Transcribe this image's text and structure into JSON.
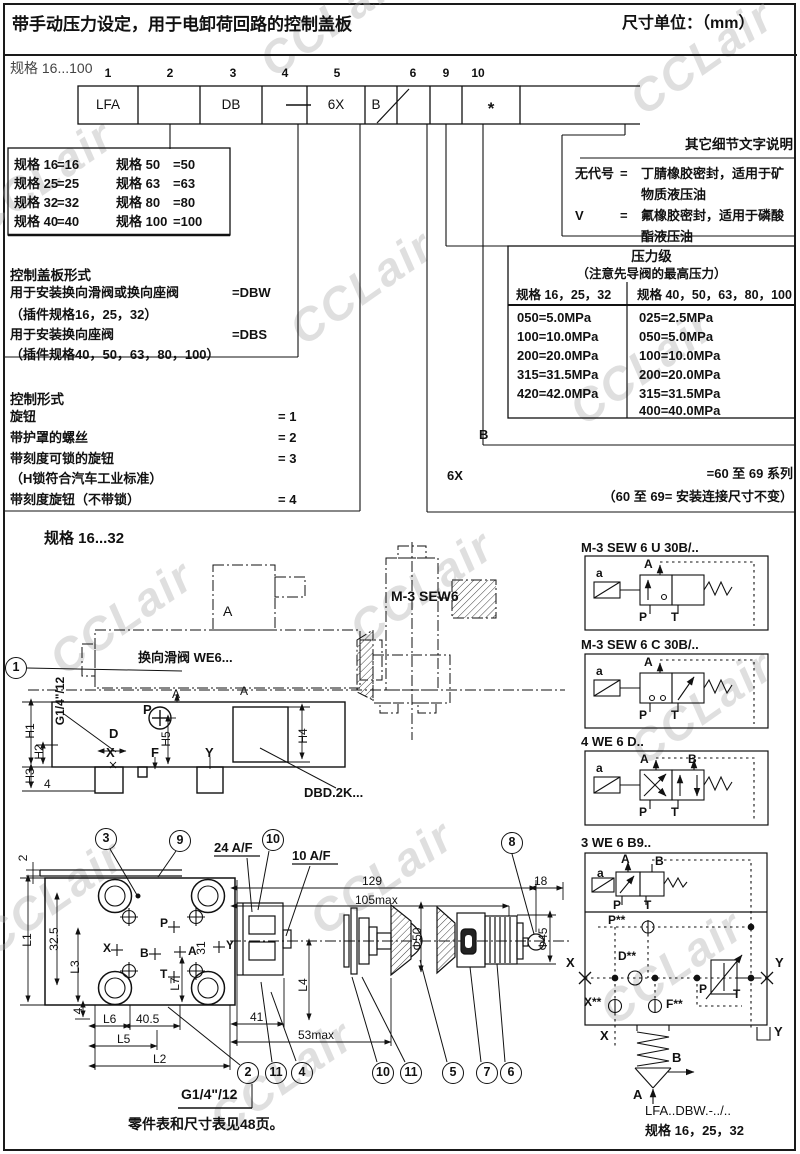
{
  "watermark": "CCLair",
  "header": {
    "title": "带手动压力设定，用于电卸荷回路的控制盖板",
    "units": "尺寸单位：（mm）"
  },
  "ordering": {
    "range": "规格 16...100",
    "positions": [
      "1",
      "2",
      "3",
      "4",
      "5",
      "6",
      "9",
      "10"
    ],
    "cells": {
      "p1": "LFA",
      "p3": "DB",
      "p5": "6X",
      "p6": "B",
      "p10": "*"
    }
  },
  "sizes": {
    "left": [
      {
        "l": "规格 16",
        "v": "=16"
      },
      {
        "l": "规格 25",
        "v": "=25"
      },
      {
        "l": "规格 32",
        "v": "=32"
      },
      {
        "l": "规格 40",
        "v": "=40"
      }
    ],
    "right": [
      {
        "l": "规格 50",
        "v": "=50"
      },
      {
        "l": "规格 63",
        "v": "=63"
      },
      {
        "l": "规格 80",
        "v": "=80"
      },
      {
        "l": "规格 100",
        "v": "=100"
      }
    ]
  },
  "seals": {
    "title": "其它细节文字说明",
    "rows": [
      {
        "code": "无代号",
        "eq": "=",
        "d1": "丁腈橡胶密封，适用于矿",
        "d2": "物质液压油"
      },
      {
        "code": "V",
        "eq": "=",
        "d1": "氟橡胶密封，适用于磷酸",
        "d2": "酯液压油"
      }
    ]
  },
  "cover": {
    "title": "控制盖板形式",
    "rows": [
      {
        "t": "用于安装换向滑阀或换向座阀",
        "v": "=DBW"
      },
      {
        "t": "（插件规格16，25，32）",
        "v": ""
      },
      {
        "t": "用于安装换向座阀",
        "v": "=DBS"
      },
      {
        "t": "（插件规格40，50，63，80，100）",
        "v": ""
      }
    ]
  },
  "pressure": {
    "title": "压力级",
    "subtitle": "（注意先导阀的最高压力）",
    "h1": "规格 16，25，32",
    "h2": "规格 40，50，63，80，100",
    "c1": [
      "050=5.0MPa",
      "100=10.0MPa",
      "200=20.0MPa",
      "315=31.5MPa",
      "420=42.0MPa"
    ],
    "c2": [
      "025=2.5MPa",
      "050=5.0MPa",
      "100=10.0MPa",
      "200=20.0MPa",
      "315=31.5MPa",
      "400=40.0MPa"
    ]
  },
  "control": {
    "title": "控制形式",
    "rows": [
      {
        "t": "旋钮",
        "v": "= 1"
      },
      {
        "t": "带护罩的螺丝",
        "v": "= 2"
      },
      {
        "t": "带刻度可锁的旋钮",
        "v": "= 3"
      },
      {
        "t": "（H锁符合汽车工业标准）",
        "v": ""
      },
      {
        "t": "带刻度旋钮（不带锁）",
        "v": "= 4"
      }
    ]
  },
  "series": {
    "b": "B",
    "code": "6X",
    "l1": "=60 至 69 系列",
    "l2": "（60 至 69= 安装连接尺寸不变）"
  },
  "dwg": {
    "heading": "规格 16...32",
    "c1": "1",
    "valve_ref": "换向滑阀 WE6...",
    "a_top": "A",
    "a_mid": "A",
    "a_mid2": "A",
    "sew": "M-3 SEW6",
    "dbd": "DBD.2K...",
    "g14": "G1/4\"/12",
    "p": "P",
    "d": "D",
    "x": "X",
    "f": "F",
    "y": "Y",
    "n4": "4",
    "h1": "H1",
    "h2": "H2",
    "h3": "H3",
    "h4": "H4",
    "h5": "H5"
  },
  "bl": {
    "c3": "3",
    "c9": "9",
    "c2": "2",
    "c11": "11",
    "c4": "4",
    "d2": "2",
    "l1": "L1",
    "d325": "32.5",
    "l3": "L3",
    "d4": "4",
    "l6": "L6",
    "d405": "40.5",
    "l5": "L5",
    "l2": "L2",
    "d31": "31",
    "l7": "L7",
    "p": "P",
    "b": "B",
    "x": "X",
    "a": "A",
    "y": "Y",
    "t": "T",
    "g14": "G1/4\"/12"
  },
  "bm": {
    "af24": "24 A/F",
    "af10": "10 A/F",
    "d129": "129",
    "d105": "105max",
    "d18": "18",
    "phi50": "Φ50",
    "phi45": "Φ45",
    "l4": "L4",
    "d41": "41",
    "d53": "53max",
    "c10": "10",
    "c8": "8",
    "c11": "11",
    "c5": "5",
    "c7": "7",
    "c6": "6"
  },
  "note": "零件表和尺寸表见48页。",
  "rp": {
    "titles": [
      "M-3 SEW 6 U 30B/..",
      "M-3 SEW 6 C 30B/..",
      "4 WE 6 D..",
      "3 WE 6 B9.."
    ],
    "a": "a",
    "A": "A",
    "B": "B",
    "P": "P",
    "T": "T",
    "pss": "P**",
    "dss": "D**",
    "xss": "X**",
    "fss": "F**",
    "x": "X",
    "y": "Y",
    "b": "B",
    "am": "A",
    "model": "LFA..DBW.-../..",
    "size": "规格 16，25，32"
  }
}
